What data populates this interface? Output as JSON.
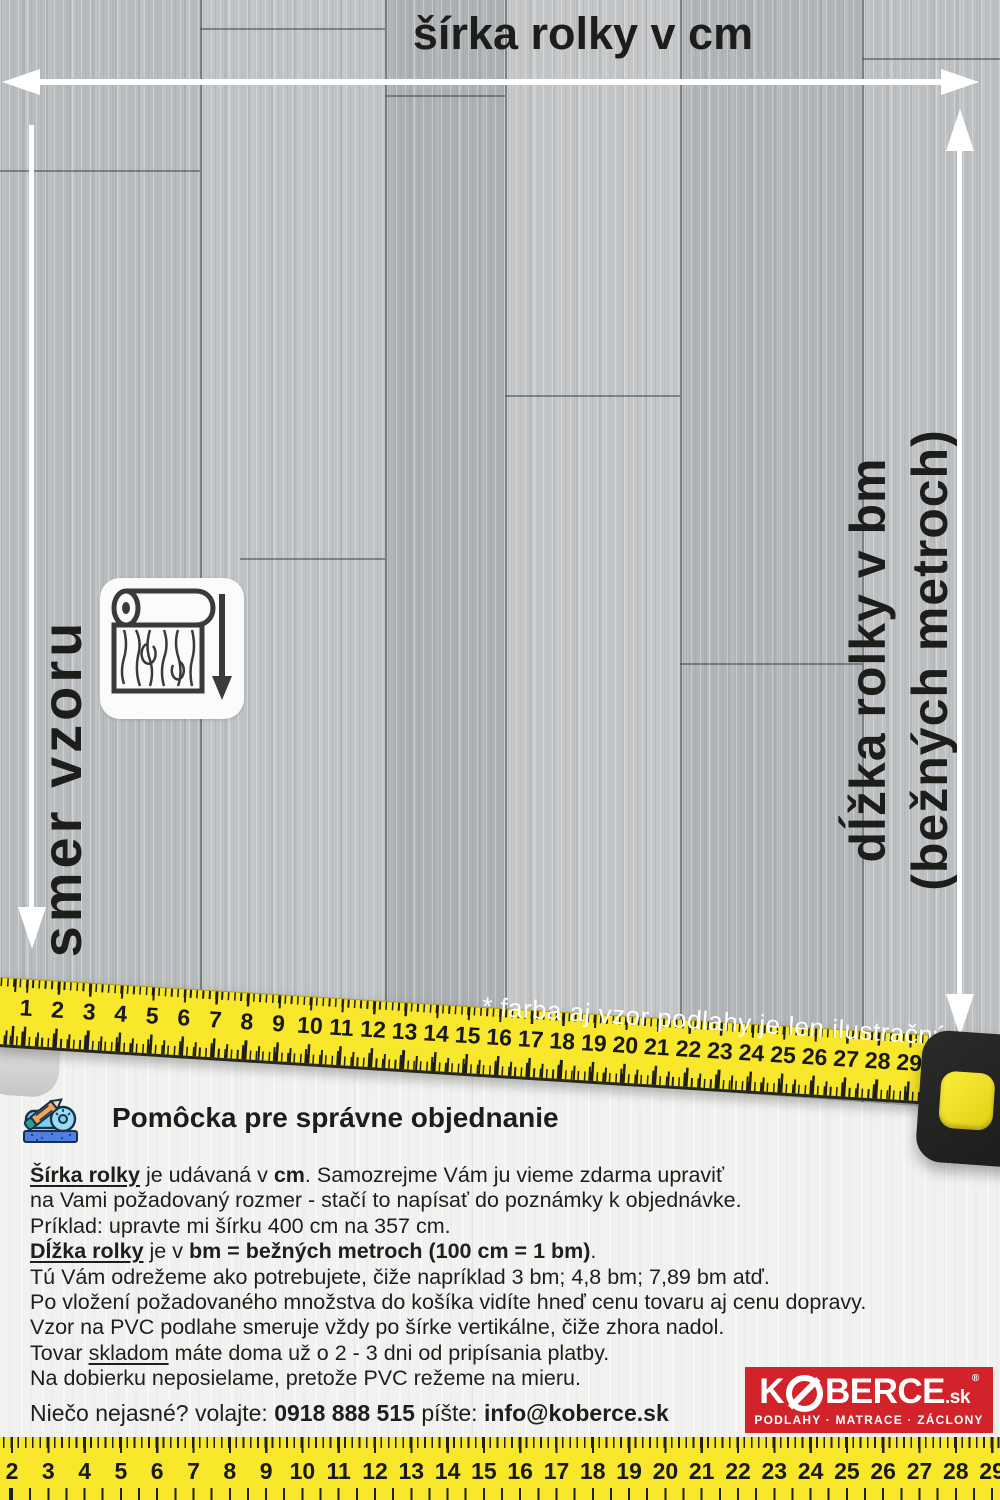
{
  "annotations": {
    "width_label": "šírka rolky v cm",
    "pattern_direction_label": "smer vzoru",
    "length_label_line1": "dĺžka rolky v bm",
    "length_label_line2": "(bežných metroch)",
    "disclaimer": "* farba aj vzor podlahy je len ilustračný"
  },
  "middle_tape": {
    "numbers": [
      1,
      2,
      3,
      4,
      5,
      6,
      7,
      8,
      9,
      10,
      11,
      12,
      13,
      14,
      15,
      16,
      17,
      18,
      19,
      20,
      21,
      22,
      23,
      24,
      25,
      26,
      27,
      28,
      29
    ]
  },
  "bottom_tape": {
    "numbers": [
      2,
      3,
      4,
      5,
      6,
      7,
      8,
      9,
      10,
      11,
      12,
      13,
      14,
      15,
      16,
      17,
      18,
      19,
      20,
      21,
      22,
      23,
      24,
      25,
      26,
      27,
      28,
      29
    ]
  },
  "help": {
    "heading": "Pomôcka pre správne objednanie",
    "lines": [
      [
        {
          "t": "Šírka rolky",
          "b": true,
          "u": true
        },
        {
          "t": " je udávaná v "
        },
        {
          "t": "cm",
          "b": true
        },
        {
          "t": ". Samozrejme Vám ju vieme zdarma upraviť"
        }
      ],
      [
        {
          "t": "na Vami požadovaný rozmer - stačí to napísať do poznámky k objednávke."
        }
      ],
      [
        {
          "t": "Príklad: upravte mi šírku 400 cm na 357 cm."
        }
      ],
      [
        {
          "t": "Dĺžka rolky",
          "b": true,
          "u": true
        },
        {
          "t": " je v "
        },
        {
          "t": "bm = bežných metroch (100 cm = 1 bm)",
          "b": true
        },
        {
          "t": "."
        }
      ],
      [
        {
          "t": "Tú Vám odrežeme ako potrebujete, čiže napríklad 3 bm; 4,8 bm; 7,89 bm atď."
        }
      ],
      [
        {
          "t": "Po vložení požadovaného množstva do košíka vidíte hneď cenu tovaru aj cenu dopravy."
        }
      ],
      [
        {
          "t": "Vzor na PVC podlahe smeruje vždy po šírke vertikálne, čiže zhora nadol."
        }
      ],
      [
        {
          "t": "Tovar "
        },
        {
          "t": "skladom",
          "u": true
        },
        {
          "t": " máte doma už o 2 - 3 dni od pripísania platby."
        }
      ],
      [
        {
          "t": "Na dobierku neposielame, pretože PVC režeme na mieru."
        }
      ]
    ]
  },
  "contact": {
    "prefix": "Niečo nejasné? volajte:",
    "phone": "0918 888 515",
    "write_label": "píšte:",
    "email": "info@koberce.sk"
  },
  "logo": {
    "brand_prefix": "K",
    "brand_suffix": "BERCE",
    "tld": ".sk",
    "registered": "®",
    "tagline": "PODLAHY · MATRACE · ZÁCLONY"
  },
  "colors": {
    "tape_yellow": "#f8e72a",
    "logo_red": "#d2232a",
    "ink": "#1d1d1b",
    "floor_gray": "#b5b8ba"
  }
}
